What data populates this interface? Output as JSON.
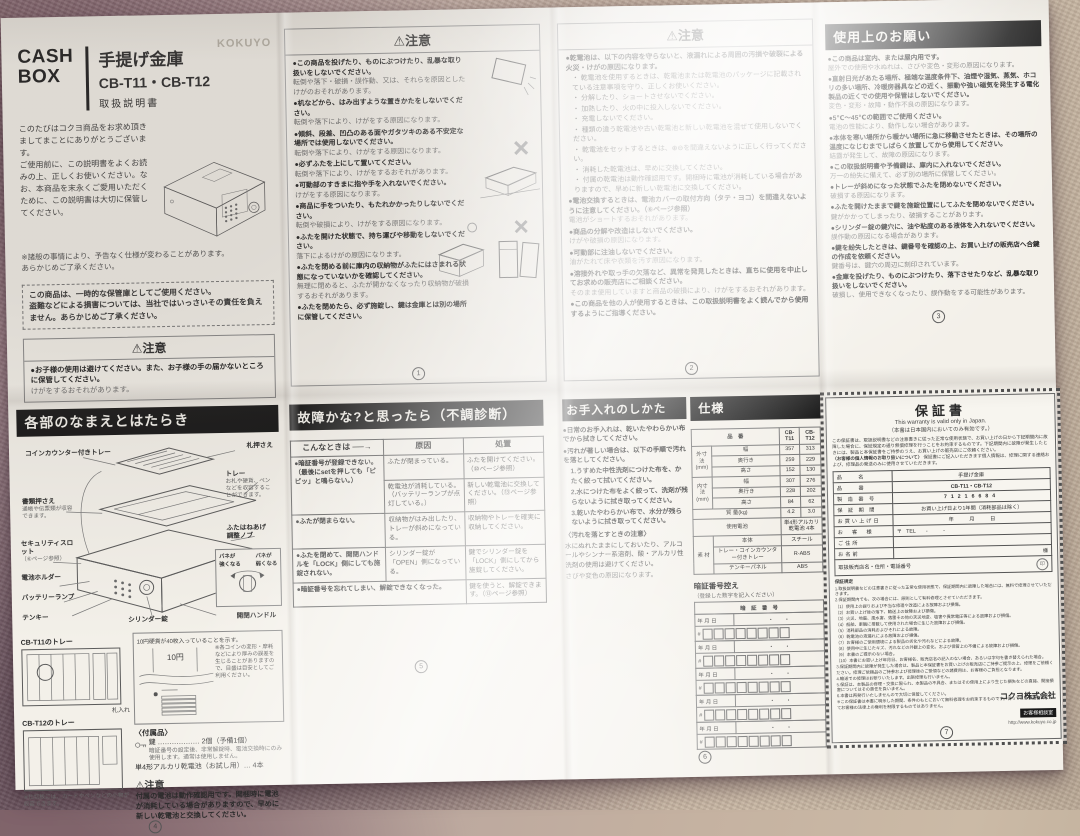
{
  "cover": {
    "brand": "KOKUYO",
    "title_en": "CASH\nBOX",
    "title_ja": "手提げ金庫",
    "model": "CB-T11・CB-T12",
    "doc_type": "取扱説明書",
    "intro": "このたびはコクヨ商品をお求め頂きましてまことにありがとうございます。\nご使用前に、この説明書をよくお読みの上、正しくお使いください。なお、本商品を末永くご愛用いただくために、この説明書は大切に保管してください。",
    "note": "※諸般の事情により、予告なく仕様が変わることがあります。\nあらかじめご了承ください。",
    "disclaimer": "この商品は、一時的な保管庫としてご使用ください。\n盗難などによる損害については、当社ではいっさいその責任を負えません。あらかじめご了承ください。",
    "caution_title": "⚠注意",
    "caution_b": "●お子様の使用は避けてください。また、お子様の手の届かないところに保管してください。",
    "caution_d": "けがをするおそれがあります。"
  },
  "caution1": {
    "title": "⚠注意",
    "items": [
      {
        "b": "●この商品を投げたり、ものにぶつけたり、乱暴な取り扱いをしないでください。",
        "d": "転倒や落下・破損・誤作動、又は、それらを原因としたけがのおそれがあります。"
      },
      {
        "b": "●机などから、はみ出すような置きかたをしないでください。",
        "d": "転倒や落下により、けがをする原因になります。"
      },
      {
        "b": "●傾斜、段差、凹凸のある面やガタツキのある不安定な場所では使用しないでください。",
        "d": "転倒や落下により、けがをする原因になります。"
      },
      {
        "b": "●必ずふたを上にして置いてください。",
        "d": "転倒や落下により、けがをするおそれがあります。"
      },
      {
        "b": "●可動部のすきまに指や手を入れないでください。",
        "d": "けがをする原因になります。"
      },
      {
        "b": "●商品に手をついたり、もたれかかったりしないでください。",
        "d": "転倒や破損により、けがをする原因になります。"
      },
      {
        "b": "●ふたを開けた状態で、持ち運びや移動をしないでください。",
        "d": "落下によるけがの原因になります。"
      },
      {
        "b": "●ふたを閉める前に庫内の収納物がふたにはさまれる状態になっていないかを確認してください。",
        "d": "無理に閉めると、ふたが開かなくなったり収納物が破損するおそれがあります。"
      },
      {
        "b": "●ふたを閉めたら、必ず施錠し、鍵は金庫とは別の場所に保管してください。",
        "d": ""
      }
    ],
    "mark_wrong": "×",
    "mark_right": "○",
    "page": "1"
  },
  "caution2": {
    "title": "⚠注意",
    "lead": "●乾電池は、以下の内容を守らないと、液漏れによる周囲の汚損や破裂による火災・けがの原因になります。",
    "subs": [
      "乾電池を使用するときは、乾電池または乾電池のパッケージに記載されている注意事項を守り、正しくお使いください。",
      "分解したり、ショートさせないでください。",
      "加熱したり、火の中に投入しないでください。",
      "充電しないでください。",
      "種類の違う乾電池や古い乾電池と新しい乾電池を混ぜて使用しないでください。",
      "乾電池をセットするときは、⊕⊖を間違えないように正しく行ってください。",
      "消耗した乾電池は、早めに交換してください。",
      "付属の乾電池は動作確認用です。開梱時に電池が消耗している場合がありますので、早めに新しい乾電池に交換してください。"
    ],
    "items": [
      {
        "b": "●電池交換するときは、電池カバーの取付方向（タテ・ヨコ）を間違えないように注意してください。（⑥ページ参照）",
        "d": "電池がショートするおそれがあります。"
      },
      {
        "b": "●商品の分解や改造はしないでください。",
        "d": "けがや破損の原因になります。"
      },
      {
        "b": "●可動部に注油しないでください。",
        "d": "油がたれて床や衣類を汚す原因になります。"
      },
      {
        "b": "●溶接外れや取っ手の欠落など、異常を発見したときは、直ちに使用を中止してお求めの販売店にご相談ください。",
        "d": "そのまま使用していますと商品の破損により、けがをするおそれがあります。"
      },
      {
        "b": "●この商品を他の人が使用するときは、この取扱説明書をよく読んでから使用するようにご指導ください。",
        "d": ""
      }
    ],
    "page": "2"
  },
  "usage": {
    "title": "使用上のお願い",
    "items": [
      {
        "b": "●この商品は室内、または屋内用です。",
        "d": "屋外での使用や水ぬれは、さびや変色・変形の原因になります。"
      },
      {
        "b": "●直射日光があたる場所、極端な温度条件下、油煙や湿気、蒸気、ホコリの多い場所、冷暖房器具などの近く、振動や強い磁気を発生する電化製品の近くでの使用や保管はしないでください。",
        "d": "変色・変形・故障・動作不良の原因になります。"
      },
      {
        "b": "●5℃〜45℃の範囲でご使用ください。",
        "d": "電池の性能により、動作しない場合があります。"
      },
      {
        "b": "●本体を寒い場所から暖かい場所に急に移動させたときは、その場所の温度になじむまでしばらく放置してから使用してください。",
        "d": "結露が発生して、故障の原因になります。"
      },
      {
        "b": "●この取扱説明書や予備鍵は、庫内に入れないでください。",
        "d": "万一の紛失に備えて、必ず別の場所に保管してください。"
      },
      {
        "b": "●トレーが斜めになった状態でふたを閉めないでください。",
        "d": "破損する原因になります。"
      },
      {
        "b": "●ふたを開けたままで鍵を施錠位置にしてふたを閉めないでください。",
        "d": "鍵がかかってしまったり、破損することがあります。"
      },
      {
        "b": "●シリンダー錠の鍵穴に、油や粘度のある液体を入れないでください。",
        "d": "誤作動の原因になる場合があります。"
      },
      {
        "b": "●鍵を紛失したときは、鍵番号を確認の上、お買い上げの販売店へ合鍵の作成を依頼ください。",
        "d": "鍵番号は、鍵穴の周辺に刻印されています。"
      },
      {
        "b": "●金庫を投げたり、ものにぶつけたり、落下させたりなど、乱暴な取り扱いをしないでください。",
        "d": "破損し、使用できなくなったり、誤作動をする可能性があります。"
      }
    ],
    "page": "3"
  },
  "parts": {
    "title": "各部のなまえとはたらき",
    "labels": {
      "coin_tray": "コインカウンター付きトレー",
      "bill_holder": "札押さえ",
      "tray": "トレー",
      "tray_note": "お札や硬貨、ペンなどを収容することができます。",
      "doc_holder": "書類押さえ",
      "doc_note": "通帳や伝票類が収容できます。",
      "slot": "セキュリティスロット",
      "slot_note": "（⑥ページ参照）",
      "battery_holder": "電池ホルダー",
      "battery_lamp": "バッテリーランプ",
      "keypad": "テンキー",
      "cylinder": "シリンダー錠",
      "handle": "開閉ハンドル",
      "lid_knob": "ふたはねあげ\n調整ノブ",
      "spring_strong": "バネが\n強くなる",
      "spring_weak": "バネが\n弱くなる"
    },
    "counter": {
      "caption": "10円硬貨が40枚入っていることを示す。",
      "coin": "10円",
      "note": "※各コインの変形・摩耗などにより厚みの誤差を生じることがありますので、目盛は目安としてご利用ください。"
    },
    "trays": {
      "t11": "CB-T11のトレー",
      "t12": "CB-T12のトレー",
      "bill_slot": "札入れ",
      "divider_note": "※仕切板には、カードやペンなどの小物が収容できます。"
    },
    "accessories": {
      "title": "〈付属品〉",
      "key_line": "鍵 ……………… 2個（予備1個）",
      "key_note": "暗証番号の設定後、非常解錠時、電池交換時にのみ使用します。通常は使用しません。",
      "battery_line": "単4形アルカリ乾電池（お試し用）… 4本"
    },
    "caution_title": "⚠注意",
    "caution_text": "付属の電池は動作確認用です。開梱時に電池が消耗している場合がありますので、早めに新しい乾電池と交換してください。",
    "page": "4"
  },
  "trouble": {
    "title": "故障かな?と思ったら（不調診断）",
    "col_symptom": "こんなときは ──→",
    "col_cause": "原因",
    "col_fix": "処置",
    "r1_symptom": "●暗証番号が登録できない。（最後にsetを押しても「ピピッ」と鳴らない。）",
    "r1_cause1": "ふたが閉まっている。",
    "r1_fix1": "ふたを開けてください。（⑩ページ参照）",
    "r1_cause2": "乾電池が消耗している。（バッテリーランプが点灯している。）",
    "r1_fix2": "新しい乾電池に交換してください。（⑬ページ参照）",
    "r2_symptom": "●ふたが閉まらない。",
    "r2_cause": "収納物がはみ出したり、トレーが斜めになっている。",
    "r2_fix": "収納物やトレーを確実に収納してください。",
    "r3_symptom": "●ふたを閉めて、開閉ハンドルを「LOCK」側にしても施錠されない。",
    "r3_cause": "シリンダー錠が「OPEN」側になっている。",
    "r3_fix": "鍵でシリンダー錠を「LOCK」側にしてから施錠してください。",
    "r4_symptom": "●暗証番号を忘れてしまい、解錠できなくなった。",
    "r4_fix": "鍵を使うと、解錠できます。（⑬ページ参照）",
    "page": "5"
  },
  "care": {
    "title": "お手入れのしかた",
    "items": [
      "●日常のお手入れは、乾いたやわらかい布でから拭きしてください。",
      "●汚れが著しい場合は、以下の手順で汚れを落としてください。"
    ],
    "steps": [
      "1.うすめた中性洗剤につけた布を、かたく絞って拭いてください。",
      "2.水につけた布をよく絞って、洗剤が残らないように拭き取ってください。",
      "3.乾いたやわらかい布で、水分が残らないように拭き取ってください。"
    ],
    "note_title": "〈汚れを落とすときの注意〉",
    "note_body": "水にぬれたままにしておいたり、アルコールやシンナー系溶剤、酸・アルカリ性洗剤の使用は避けてください。",
    "note_detail": "さびや変色の原因になります。"
  },
  "spec": {
    "title": "仕様",
    "head_item": "品　番",
    "head_t11": "CB-T11",
    "head_t12": "CB-T12",
    "outer_label": "外寸法\n(mm)",
    "outer": [
      [
        "幅",
        "357",
        "313"
      ],
      [
        "奥行き",
        "259",
        "229"
      ],
      [
        "高さ",
        "152",
        "130"
      ]
    ],
    "inner_label": "内寸法\n(mm)",
    "inner": [
      [
        "幅",
        "307",
        "276"
      ],
      [
        "奥行き",
        "228",
        "202"
      ],
      [
        "高さ",
        "84",
        "62"
      ]
    ],
    "weight_label": "質 量(kg)",
    "weight_t11": "4.2",
    "weight_t12": "3.0",
    "battery_label": "使用電池",
    "battery_value": "単4形アルカリ\n乾電池 4本",
    "material_label": "素 材",
    "materials": [
      [
        "本体",
        "スチール"
      ],
      [
        "トレー・コインカウンター付きトレー",
        "R-ABS"
      ],
      [
        "テンキーパネル",
        "ABS"
      ]
    ]
  },
  "pin": {
    "title": "暗証番号控え",
    "subtitle": "（登録した数字を記入ください）",
    "col": "暗　証　番　号",
    "date_label": "年 月 日",
    "dots": "・　　・",
    "hash": "#",
    "rows": [
      1,
      2,
      3,
      4,
      5
    ],
    "page": "6"
  },
  "warranty": {
    "title": "保証書",
    "en": "This warranty is valid only in Japan.",
    "jp": "（本書は日本国内においてのみ有効です。）",
    "intro": "この保証書は、取扱説明書などの注意書きに従った正常な使用状態で、お買い上げの日から下記期間内に故障した場合に、保証規定の通り無償修理を行うことをお約束するものです。下記期間内に故障が発生したときには、製品と本保証書をご持参のうえ、お買い上げの販売店にご依頼ください。",
    "privacy_title": "〈お客様の個人情報のお取り扱いについて〉",
    "privacy_body": "保証書にご記入いただきます個人情報は、修理に関する連絡および、修理品の発送のみに使用させていただきます。",
    "f_item_label": "品　　名",
    "f_item": "手提げ金庫",
    "f_model_label": "品　　番",
    "f_model": "CB-T11・CB-T12",
    "f_serial_label": "製 造 番 号",
    "f_serial": "71216684",
    "f_period_label": "保 証 期 間",
    "f_period": "お買い上げ日より1年間（消耗部品は除く）",
    "f_date_label": "お買い上げ日",
    "f_date": "年　　　月　　　日",
    "f_customer_label": "お　客　様",
    "f_customer": "〒",
    "f_tel": "TEL　　-　　　-",
    "f_address_label": "ご住所",
    "f_name_label": "お名前",
    "f_name_suffix": "様",
    "f_shop_label": "取扱販売店名・住所・電話番号",
    "f_stamp": "印",
    "terms_title": "保証規定",
    "terms": [
      "1.取扱説明書などの注意書きに従った正常な使用状態で、保証期間内に故障した場合には、無料で修理させていただきます。",
      "2.保証期間内でも、次の場合には、原則として有料修理とさせていただきます。",
      "（1）使用上の誤りおよび不当な修理や改造による故障および損傷。",
      "（2）お買い上げ後の落下、輸送上の故障および損傷。",
      "（3）火災、地震、風水害、落雷その他の天災地変、塩害や異常電圧等による故障および損傷。",
      "（4）船舶、車輌に搭載して使用された場合に生じた故障および損傷。",
      "（5）消耗部品の消耗およびそれによる故障。",
      "（6）乾電池の液漏れによる故障および損傷。",
      "（7）お客様のご使用環境による製品の劣化や汚れなどによる故障。",
      "（8）使用中に生じたキズ、汚れなどの外観上の変化、および保管上の不備による故障および損傷。",
      "（9）本書のご提示のない場合。",
      "（10）本書にお買い上げ年月日、お客様名、販売店名の記入のない場合、あるいは字句を書き替えられた場合。",
      "3.保証期間内に故障が発生した場合は、製品と本保証書をお買い上げの販売店にご持参ご提示の上、修理をご依頼ください。修理ご依頼品のご持参および修理後のご受領などの諸費用は、お客様のご負担となります。",
      "4.輸送での修理はお断りいたします。出張修理も行いません。",
      "5.保証は、本製品の修理・交換に限られ、本製品の不具合、またはその使用上により生じた損失などの直接、間接損害についてはその責任を負いません。",
      "6.本書は再発行いたしませんので大切に保管してください。",
      "※この保証書は本書に明示した期間、条件のもとにおいて無料修理をお約束するものです。従ってこの保証書によってお客様の法律上の権利を制限するものではありません。"
    ],
    "company": "コクヨ株式会社",
    "support": "お客様相談室",
    "url": "http://www.kokuyo.co.jp",
    "page": "7"
  }
}
